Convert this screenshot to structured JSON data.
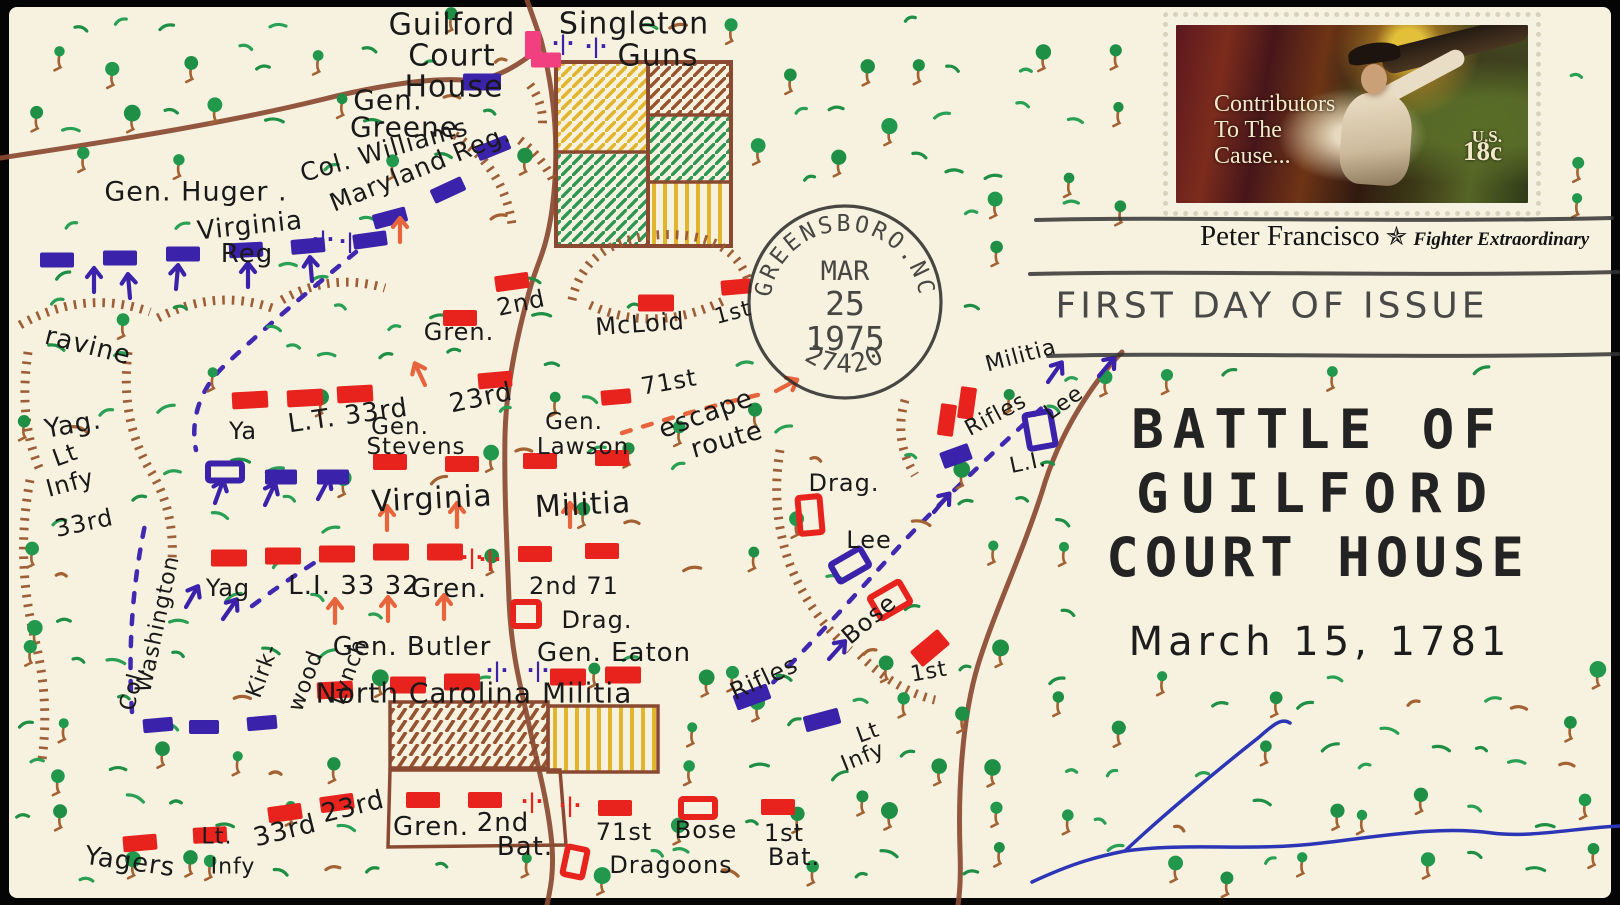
{
  "envelope": {
    "type": "first day cover, hand-drawn battle map cachet"
  },
  "stamp": {
    "title_line1": "Contributors",
    "title_line2": "To The",
    "title_line3": "Cause...",
    "country": "U.S.",
    "denomination": "18c",
    "caption_name": "Peter Francisco",
    "caption_epithet": "Fighter Extraordinary",
    "star_icon": "bicentennial-star"
  },
  "postmark": {
    "city_arc": "GREENSBORO.NC",
    "month": "MAR",
    "day": "25",
    "year": "1975",
    "zip_arc": "27420"
  },
  "cancellation": {
    "slogan": "FIRST DAY OF ISSUE"
  },
  "cachet_title": {
    "line1": "BATTLE OF",
    "line2": "GUILFORD",
    "line3": "COURT HOUSE",
    "date": "March 15, 1781"
  },
  "colors": {
    "envelope": "#f7f2df",
    "ink": "#191919",
    "red_unit": "#e8231d",
    "blue_unit": "#3a22aa",
    "road": "#8a4a32",
    "hatch_brown": "#99572f",
    "tree_green": "#21984c",
    "grass_green": "#2aa055",
    "trunk_brown": "#a36233",
    "creek_blue": "#2b35b5",
    "field_yellow": "#e2b52e",
    "field_green": "#2d9653",
    "house_pink": "#f23f7f",
    "postmark_ink": "#2d2d2d"
  },
  "map": {
    "labels": [
      {
        "t": "Guilford",
        "x": 452,
        "y": 25,
        "s": 30,
        "r": 0
      },
      {
        "t": "Court",
        "x": 452,
        "y": 56,
        "s": 30,
        "r": 0
      },
      {
        "t": "House",
        "x": 454,
        "y": 87,
        "s": 30,
        "r": 0
      },
      {
        "t": "Gen.",
        "x": 388,
        "y": 100,
        "s": 28,
        "r": 0
      },
      {
        "t": "Greene",
        "x": 404,
        "y": 127,
        "s": 28,
        "r": 0
      },
      {
        "t": "Singleton",
        "x": 634,
        "y": 24,
        "s": 30,
        "r": 0
      },
      {
        "t": "Guns",
        "x": 658,
        "y": 56,
        "s": 30,
        "r": 0
      },
      {
        "t": "Col. Williams",
        "x": 384,
        "y": 150,
        "s": 25,
        "r": -16
      },
      {
        "t": "Maryland Reg.",
        "x": 420,
        "y": 168,
        "s": 25,
        "r": -22
      },
      {
        "t": "Gen. Huger .",
        "x": 196,
        "y": 192,
        "s": 27,
        "r": 0
      },
      {
        "t": "Virginia",
        "x": 250,
        "y": 226,
        "s": 26,
        "r": -6
      },
      {
        "t": "Reg",
        "x": 247,
        "y": 254,
        "s": 26,
        "r": 0
      },
      {
        "t": "ravine",
        "x": 88,
        "y": 346,
        "s": 26,
        "r": 14
      },
      {
        "t": "Yag.",
        "x": 73,
        "y": 425,
        "s": 26,
        "r": -10
      },
      {
        "t": "Lt",
        "x": 65,
        "y": 455,
        "s": 24,
        "r": -20
      },
      {
        "t": "Infy",
        "x": 70,
        "y": 483,
        "s": 24,
        "r": -15
      },
      {
        "t": "33rd",
        "x": 84,
        "y": 523,
        "s": 24,
        "r": -12
      },
      {
        "t": "Ya",
        "x": 243,
        "y": 431,
        "s": 24,
        "r": 0
      },
      {
        "t": "L.T. 33rd",
        "x": 348,
        "y": 416,
        "s": 26,
        "r": -8
      },
      {
        "t": "Gen.",
        "x": 400,
        "y": 427,
        "s": 23,
        "r": 0
      },
      {
        "t": "Stevens",
        "x": 416,
        "y": 447,
        "s": 23,
        "r": 0
      },
      {
        "t": "23rd",
        "x": 481,
        "y": 398,
        "s": 26,
        "r": -12
      },
      {
        "t": "Gen.",
        "x": 574,
        "y": 422,
        "s": 23,
        "r": 0
      },
      {
        "t": "Lawson",
        "x": 583,
        "y": 447,
        "s": 23,
        "r": 0
      },
      {
        "t": "2nd",
        "x": 521,
        "y": 303,
        "s": 24,
        "r": -12
      },
      {
        "t": "Gren.",
        "x": 459,
        "y": 332,
        "s": 24,
        "r": 0
      },
      {
        "t": "McLoid",
        "x": 640,
        "y": 324,
        "s": 24,
        "r": -4
      },
      {
        "t": "1st",
        "x": 733,
        "y": 313,
        "s": 22,
        "r": -15
      },
      {
        "t": "71st",
        "x": 669,
        "y": 382,
        "s": 24,
        "r": -10
      },
      {
        "t": "escape",
        "x": 706,
        "y": 414,
        "s": 26,
        "r": -20
      },
      {
        "t": "route",
        "x": 727,
        "y": 440,
        "s": 26,
        "r": -16
      },
      {
        "t": "Virginia",
        "x": 432,
        "y": 499,
        "s": 30,
        "r": -3
      },
      {
        "t": "Militia",
        "x": 583,
        "y": 505,
        "s": 30,
        "r": -3
      },
      {
        "t": "Yag",
        "x": 228,
        "y": 588,
        "s": 24,
        "r": 0
      },
      {
        "t": "L.I. 33 32",
        "x": 354,
        "y": 586,
        "s": 26,
        "r": 0
      },
      {
        "t": "Gren.",
        "x": 449,
        "y": 589,
        "s": 26,
        "r": 0
      },
      {
        "t": "2nd 71",
        "x": 574,
        "y": 586,
        "s": 24,
        "r": 0
      },
      {
        "t": "Drag.",
        "x": 597,
        "y": 620,
        "s": 24,
        "r": 0
      },
      {
        "t": "Gen. Butler",
        "x": 412,
        "y": 647,
        "s": 26,
        "r": 0
      },
      {
        "t": "Gen. Eaton",
        "x": 614,
        "y": 653,
        "s": 26,
        "r": 0
      },
      {
        "t": "North Carolina Militia",
        "x": 474,
        "y": 693,
        "s": 28,
        "r": 0
      },
      {
        "t": "Col.",
        "x": 133,
        "y": 688,
        "s": 22,
        "r": -75
      },
      {
        "t": "Washington",
        "x": 158,
        "y": 624,
        "s": 22,
        "r": -78
      },
      {
        "t": "Kirk-",
        "x": 263,
        "y": 671,
        "s": 22,
        "r": -70
      },
      {
        "t": "wood",
        "x": 306,
        "y": 681,
        "s": 22,
        "r": -70
      },
      {
        "t": "Lynch",
        "x": 349,
        "y": 672,
        "s": 22,
        "r": -70
      },
      {
        "t": "Yagers",
        "x": 130,
        "y": 862,
        "s": 26,
        "r": 8
      },
      {
        "t": "Lt.",
        "x": 217,
        "y": 837,
        "s": 22,
        "r": 0
      },
      {
        "t": "Infy",
        "x": 233,
        "y": 867,
        "s": 22,
        "r": 0
      },
      {
        "t": "33rd",
        "x": 285,
        "y": 831,
        "s": 26,
        "r": -14
      },
      {
        "t": "23rd",
        "x": 353,
        "y": 807,
        "s": 26,
        "r": -14
      },
      {
        "t": "Gren.",
        "x": 431,
        "y": 827,
        "s": 26,
        "r": 0
      },
      {
        "t": "2nd",
        "x": 503,
        "y": 823,
        "s": 26,
        "r": 0
      },
      {
        "t": "Bat.",
        "x": 525,
        "y": 847,
        "s": 26,
        "r": 0
      },
      {
        "t": "71st",
        "x": 624,
        "y": 832,
        "s": 24,
        "r": 0
      },
      {
        "t": "Bose",
        "x": 706,
        "y": 830,
        "s": 24,
        "r": 0
      },
      {
        "t": "1st",
        "x": 784,
        "y": 833,
        "s": 24,
        "r": 0
      },
      {
        "t": "Dragoons",
        "x": 671,
        "y": 865,
        "s": 24,
        "r": 0
      },
      {
        "t": "Bat.",
        "x": 794,
        "y": 857,
        "s": 24,
        "r": 0
      },
      {
        "t": "Rifles",
        "x": 764,
        "y": 678,
        "s": 24,
        "r": -25
      },
      {
        "t": "Lt",
        "x": 868,
        "y": 733,
        "s": 22,
        "r": -20
      },
      {
        "t": "Infy",
        "x": 863,
        "y": 757,
        "s": 22,
        "r": -22
      },
      {
        "t": "Drag.",
        "x": 844,
        "y": 483,
        "s": 24,
        "r": 0
      },
      {
        "t": "Lee",
        "x": 869,
        "y": 540,
        "s": 24,
        "r": 0
      },
      {
        "t": "Bose",
        "x": 869,
        "y": 619,
        "s": 24,
        "r": -40
      },
      {
        "t": "1st",
        "x": 929,
        "y": 672,
        "s": 22,
        "r": -10
      },
      {
        "t": "Militia",
        "x": 1021,
        "y": 356,
        "s": 22,
        "r": -15
      },
      {
        "t": "Rifles",
        "x": 996,
        "y": 415,
        "s": 22,
        "r": -28
      },
      {
        "t": "Lee",
        "x": 1064,
        "y": 403,
        "s": 22,
        "r": -35
      },
      {
        "t": "L.I.",
        "x": 1028,
        "y": 463,
        "s": 22,
        "r": -12
      }
    ],
    "units": [
      {
        "x": 57,
        "y": 260,
        "w": 34,
        "h": 15,
        "r": 0,
        "c": "B"
      },
      {
        "x": 120,
        "y": 258,
        "w": 34,
        "h": 15,
        "r": 0,
        "c": "B"
      },
      {
        "x": 183,
        "y": 254,
        "w": 34,
        "h": 15,
        "r": 0,
        "c": "B"
      },
      {
        "x": 246,
        "y": 250,
        "w": 34,
        "h": 15,
        "r": -3,
        "c": "B"
      },
      {
        "x": 308,
        "y": 246,
        "w": 34,
        "h": 15,
        "r": -5,
        "c": "B"
      },
      {
        "x": 370,
        "y": 240,
        "w": 34,
        "h": 15,
        "r": -8,
        "c": "B"
      },
      {
        "x": 390,
        "y": 218,
        "w": 34,
        "h": 15,
        "r": -15,
        "c": "B"
      },
      {
        "x": 448,
        "y": 190,
        "w": 34,
        "h": 15,
        "r": -25,
        "c": "B"
      },
      {
        "x": 493,
        "y": 148,
        "w": 34,
        "h": 15,
        "r": -22,
        "c": "B"
      },
      {
        "x": 482,
        "y": 82,
        "w": 38,
        "h": 17,
        "r": 0,
        "c": "B"
      },
      {
        "x": 281,
        "y": 477,
        "w": 32,
        "h": 15,
        "r": 0,
        "c": "B"
      },
      {
        "x": 333,
        "y": 477,
        "w": 32,
        "h": 15,
        "r": 0,
        "c": "B"
      },
      {
        "x": 158,
        "y": 725,
        "w": 30,
        "h": 14,
        "r": -5,
        "c": "B"
      },
      {
        "x": 204,
        "y": 727,
        "w": 30,
        "h": 14,
        "r": 0,
        "c": "B"
      },
      {
        "x": 262,
        "y": 723,
        "w": 30,
        "h": 14,
        "r": -5,
        "c": "B"
      },
      {
        "x": 752,
        "y": 697,
        "w": 36,
        "h": 16,
        "r": -20,
        "c": "B"
      },
      {
        "x": 822,
        "y": 720,
        "w": 36,
        "h": 16,
        "r": -15,
        "c": "B"
      },
      {
        "x": 956,
        "y": 456,
        "w": 30,
        "h": 17,
        "r": -20,
        "c": "B"
      },
      {
        "x": 225,
        "y": 472,
        "w": 34,
        "h": 17,
        "r": 0,
        "c": "B",
        "o": 1
      },
      {
        "x": 850,
        "y": 565,
        "w": 34,
        "h": 20,
        "r": -30,
        "c": "B",
        "o": 1
      },
      {
        "x": 1040,
        "y": 430,
        "w": 26,
        "h": 34,
        "r": -10,
        "c": "B",
        "o": 1
      },
      {
        "x": 250,
        "y": 400,
        "w": 36,
        "h": 17,
        "r": -3,
        "c": "R"
      },
      {
        "x": 305,
        "y": 398,
        "w": 36,
        "h": 17,
        "r": -3,
        "c": "R"
      },
      {
        "x": 355,
        "y": 394,
        "w": 36,
        "h": 17,
        "r": -3,
        "c": "R"
      },
      {
        "x": 495,
        "y": 380,
        "w": 34,
        "h": 16,
        "r": -5,
        "c": "R"
      },
      {
        "x": 616,
        "y": 397,
        "w": 30,
        "h": 15,
        "r": -5,
        "c": "R"
      },
      {
        "x": 512,
        "y": 282,
        "w": 34,
        "h": 16,
        "r": -8,
        "c": "R"
      },
      {
        "x": 460,
        "y": 318,
        "w": 34,
        "h": 16,
        "r": 0,
        "c": "R"
      },
      {
        "x": 656,
        "y": 303,
        "w": 36,
        "h": 17,
        "r": 0,
        "c": "R"
      },
      {
        "x": 736,
        "y": 287,
        "w": 30,
        "h": 15,
        "r": -5,
        "c": "R"
      },
      {
        "x": 390,
        "y": 462,
        "w": 34,
        "h": 16,
        "r": 0,
        "c": "R"
      },
      {
        "x": 462,
        "y": 464,
        "w": 34,
        "h": 16,
        "r": 0,
        "c": "R"
      },
      {
        "x": 540,
        "y": 461,
        "w": 34,
        "h": 16,
        "r": 0,
        "c": "R"
      },
      {
        "x": 612,
        "y": 458,
        "w": 34,
        "h": 16,
        "r": 0,
        "c": "R"
      },
      {
        "x": 229,
        "y": 558,
        "w": 36,
        "h": 17,
        "r": 0,
        "c": "R"
      },
      {
        "x": 283,
        "y": 556,
        "w": 36,
        "h": 17,
        "r": 0,
        "c": "R"
      },
      {
        "x": 337,
        "y": 554,
        "w": 36,
        "h": 17,
        "r": 0,
        "c": "R"
      },
      {
        "x": 391,
        "y": 552,
        "w": 36,
        "h": 17,
        "r": 0,
        "c": "R"
      },
      {
        "x": 445,
        "y": 552,
        "w": 36,
        "h": 17,
        "r": 0,
        "c": "R"
      },
      {
        "x": 535,
        "y": 554,
        "w": 34,
        "h": 16,
        "r": 0,
        "c": "R"
      },
      {
        "x": 602,
        "y": 551,
        "w": 34,
        "h": 16,
        "r": 0,
        "c": "R"
      },
      {
        "x": 335,
        "y": 690,
        "w": 36,
        "h": 17,
        "r": -3,
        "c": "R"
      },
      {
        "x": 408,
        "y": 685,
        "w": 36,
        "h": 17,
        "r": 0,
        "c": "R"
      },
      {
        "x": 462,
        "y": 682,
        "w": 36,
        "h": 17,
        "r": 0,
        "c": "R"
      },
      {
        "x": 568,
        "y": 677,
        "w": 36,
        "h": 17,
        "r": 0,
        "c": "R"
      },
      {
        "x": 623,
        "y": 675,
        "w": 36,
        "h": 17,
        "r": 0,
        "c": "R"
      },
      {
        "x": 140,
        "y": 843,
        "w": 34,
        "h": 16,
        "r": -5,
        "c": "R"
      },
      {
        "x": 210,
        "y": 835,
        "w": 34,
        "h": 16,
        "r": -3,
        "c": "R"
      },
      {
        "x": 285,
        "y": 813,
        "w": 34,
        "h": 16,
        "r": -8,
        "c": "R"
      },
      {
        "x": 337,
        "y": 803,
        "w": 34,
        "h": 16,
        "r": -8,
        "c": "R"
      },
      {
        "x": 423,
        "y": 800,
        "w": 34,
        "h": 16,
        "r": 0,
        "c": "R"
      },
      {
        "x": 485,
        "y": 800,
        "w": 34,
        "h": 16,
        "r": 0,
        "c": "R"
      },
      {
        "x": 615,
        "y": 808,
        "w": 34,
        "h": 16,
        "r": 0,
        "c": "R"
      },
      {
        "x": 778,
        "y": 807,
        "w": 34,
        "h": 16,
        "r": 0,
        "c": "R"
      },
      {
        "x": 930,
        "y": 648,
        "w": 36,
        "h": 20,
        "r": -40,
        "c": "R"
      },
      {
        "x": 947,
        "y": 420,
        "w": 16,
        "h": 32,
        "r": 8,
        "c": "R"
      },
      {
        "x": 967,
        "y": 403,
        "w": 16,
        "h": 32,
        "r": 8,
        "c": "R"
      },
      {
        "x": 698,
        "y": 808,
        "w": 34,
        "h": 18,
        "r": 0,
        "c": "R",
        "o": 1
      },
      {
        "x": 575,
        "y": 862,
        "w": 20,
        "h": 28,
        "r": 12,
        "c": "R",
        "o": 1
      },
      {
        "x": 526,
        "y": 614,
        "w": 26,
        "h": 24,
        "r": 0,
        "c": "R",
        "o": 1
      },
      {
        "x": 810,
        "y": 515,
        "w": 22,
        "h": 36,
        "r": -5,
        "c": "R",
        "o": 1
      },
      {
        "x": 890,
        "y": 600,
        "w": 34,
        "h": 24,
        "r": -30,
        "c": "R",
        "o": 1
      },
      {
        "x": 533,
        "y": 45,
        "w": 16,
        "h": 28,
        "r": 0,
        "c": "P"
      },
      {
        "x": 546,
        "y": 60,
        "w": 30,
        "h": 15,
        "r": 0,
        "c": "P"
      }
    ],
    "artillery": [
      {
        "x": 563,
        "y": 44,
        "c": "B"
      },
      {
        "x": 596,
        "y": 47,
        "c": "B"
      },
      {
        "x": 323,
        "y": 240,
        "c": "B"
      },
      {
        "x": 350,
        "y": 242,
        "c": "B"
      },
      {
        "x": 497,
        "y": 671,
        "c": "B"
      },
      {
        "x": 538,
        "y": 671,
        "c": "B"
      },
      {
        "x": 472,
        "y": 558,
        "c": "R"
      },
      {
        "x": 490,
        "y": 560,
        "c": "R"
      },
      {
        "x": 532,
        "y": 802,
        "c": "R"
      },
      {
        "x": 570,
        "y": 806,
        "c": "R"
      }
    ],
    "arrows": [
      {
        "x": 94,
        "y": 292,
        "r": 0,
        "c": "B"
      },
      {
        "x": 130,
        "y": 298,
        "r": -5,
        "c": "B"
      },
      {
        "x": 176,
        "y": 289,
        "r": 5,
        "c": "B"
      },
      {
        "x": 248,
        "y": 287,
        "r": 0,
        "c": "B"
      },
      {
        "x": 312,
        "y": 281,
        "r": -5,
        "c": "B"
      },
      {
        "x": 215,
        "y": 503,
        "r": 20,
        "c": "B"
      },
      {
        "x": 265,
        "y": 505,
        "r": 25,
        "c": "B"
      },
      {
        "x": 318,
        "y": 499,
        "r": 28,
        "c": "B"
      },
      {
        "x": 186,
        "y": 607,
        "r": 30,
        "c": "B"
      },
      {
        "x": 223,
        "y": 619,
        "r": 35,
        "c": "B"
      },
      {
        "x": 829,
        "y": 659,
        "r": 42,
        "c": "B"
      },
      {
        "x": 934,
        "y": 512,
        "r": 40,
        "c": "B"
      },
      {
        "x": 1048,
        "y": 382,
        "r": 35,
        "c": "B"
      },
      {
        "x": 1099,
        "y": 376,
        "r": 40,
        "c": "B"
      },
      {
        "x": 400,
        "y": 242,
        "r": 0,
        "c": "O"
      },
      {
        "x": 425,
        "y": 385,
        "r": -25,
        "c": "O"
      },
      {
        "x": 387,
        "y": 530,
        "r": 0,
        "c": "O"
      },
      {
        "x": 457,
        "y": 527,
        "r": 0,
        "c": "O"
      },
      {
        "x": 570,
        "y": 527,
        "r": 0,
        "c": "O"
      },
      {
        "x": 335,
        "y": 623,
        "r": 0,
        "c": "O"
      },
      {
        "x": 388,
        "y": 621,
        "r": 0,
        "c": "O"
      },
      {
        "x": 444,
        "y": 619,
        "r": 0,
        "c": "O"
      },
      {
        "x": 776,
        "y": 391,
        "r": 62,
        "c": "O"
      }
    ]
  }
}
